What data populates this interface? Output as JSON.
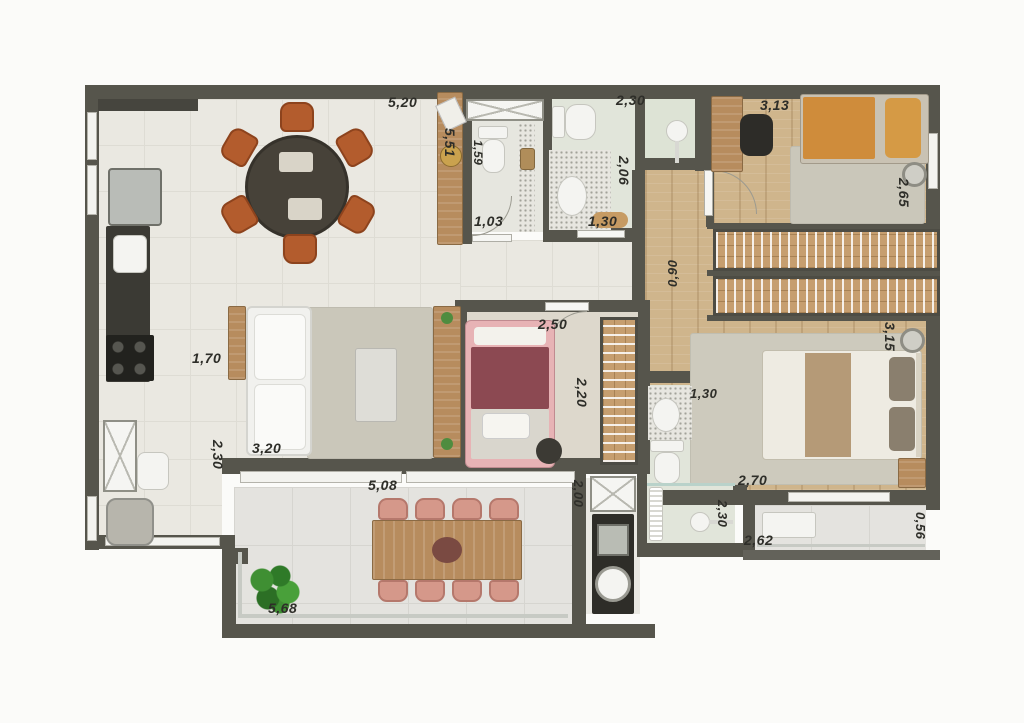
{
  "labels": {
    "dining_width": "5,20",
    "bath1_width": "2,30",
    "bedroom1_width": "3,13",
    "sideboard_length": "5,51",
    "wc_depth": "1,59",
    "wc_width": "1,03",
    "bath1_inner_width": "1,30",
    "bath1_depth": "2,06",
    "bedroom1_depth": "2,65",
    "corridor_width": "0,90",
    "kitchen_pass": "1,70",
    "bedroom2_width": "2,50",
    "bedroom2_depth": "2,20",
    "master_depth": "3,15",
    "bath2_width": "1,30",
    "living_depth": "2,30",
    "sofa_width": "3,20",
    "balcony_opening": "5,08",
    "service_depth": "2,00",
    "master_width": "2,70",
    "bath2_depth": "2,30",
    "balcony2_width": "2,62",
    "balcony2_depth": "0,56",
    "balcony_width": "5,68"
  },
  "colors": {
    "wall": "#56554c",
    "wood_floor": "#cfb58c",
    "tile_floor": "#eae8e1",
    "accent_chair_orange": "#b35c2d",
    "accent_chair_salmon": "#d5988a",
    "bed_maroon": "#8c4952",
    "bed_orange": "#cf8c3b"
  }
}
